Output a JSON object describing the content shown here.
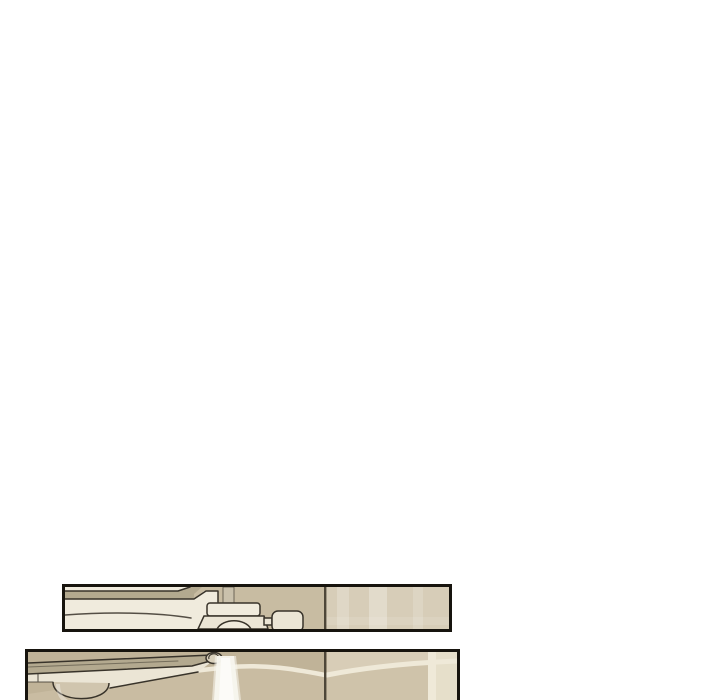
{
  "page": {
    "background": "#ffffff"
  },
  "panels": [
    {
      "alt": "Thin cropped comic panel: close-up of a cream faucet fixture and mounting block against a beige wall with a corner line"
    },
    {
      "alt": "Comic panel cut off by the bottom of the screen: a faucet spout pouring a white stream of water against a beige tiled wall"
    }
  ],
  "colors": {
    "white": "#ffffff",
    "panel_border": "#17140e",
    "outline": "#38332a",
    "fixture_top_tan": "#b3a98f",
    "fixture_cream": "#f0ebdd",
    "fixture_face": "#ebe5d5",
    "wall_beige": "#c8bca2",
    "wall_beige_light": "#d7cdb8",
    "tile_base": "#c9bca2",
    "tile_dark": "#beb197",
    "tile_mid": "#cfc3aa",
    "tile_light": "#dcd2bc",
    "tile_lighter": "#e6dfca",
    "grout": "#efe9d8",
    "corner_line": "#4e4739",
    "water": "#f7f5ee",
    "water_core": "#fcfbf8",
    "pipe_gray": "#cbc2ae",
    "knob_beige": "#d0c5ae",
    "spout_beige": "#d9d0bb"
  }
}
